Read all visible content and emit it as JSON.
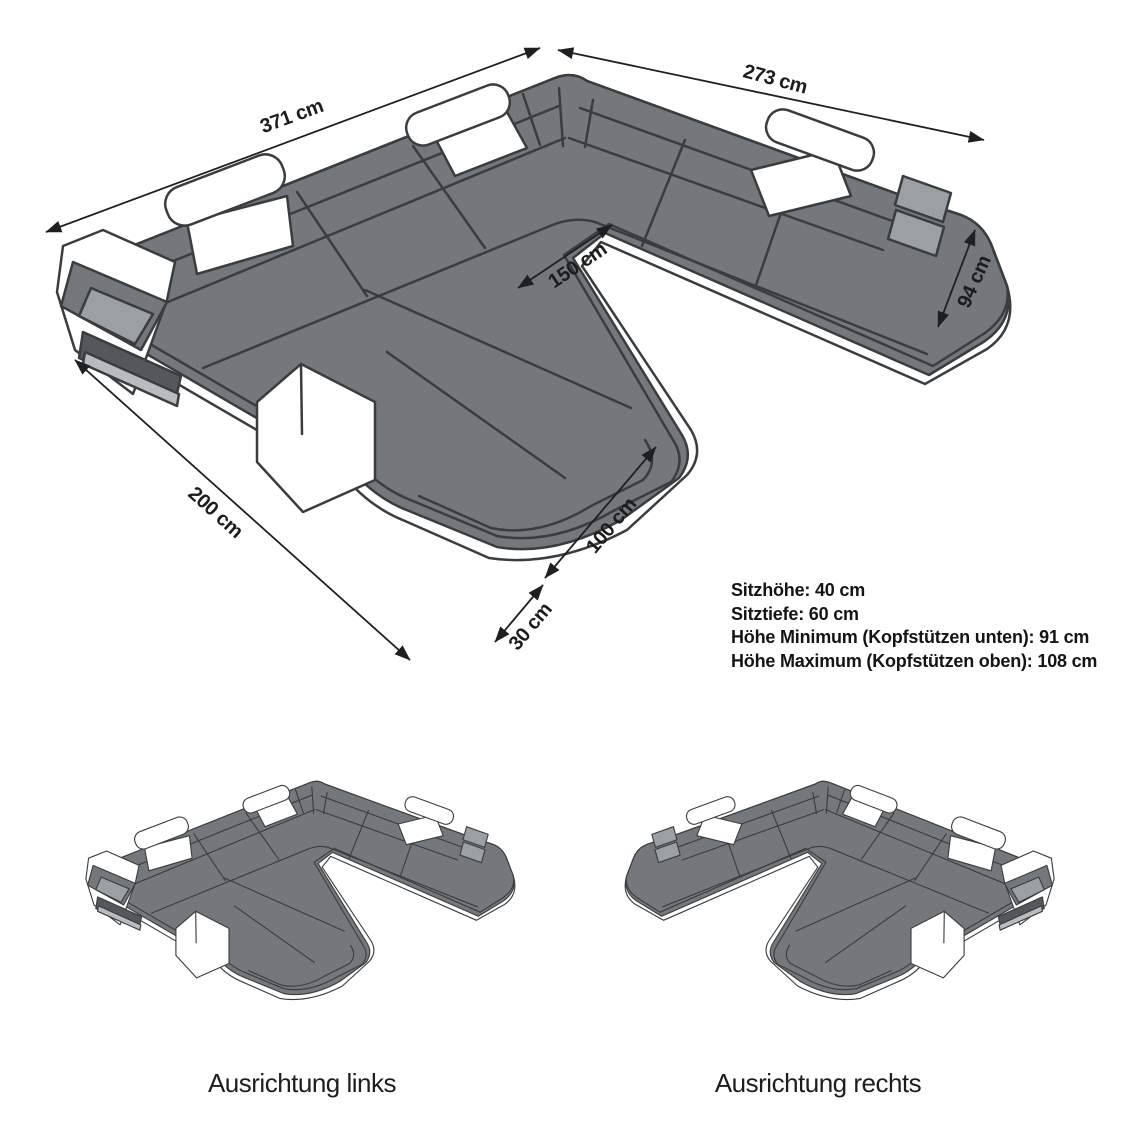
{
  "diagram": {
    "dimensions": [
      {
        "id": "371",
        "label": "371 cm"
      },
      {
        "id": "273",
        "label": "273 cm"
      },
      {
        "id": "150",
        "label": "150 cm"
      },
      {
        "id": "94",
        "label": "94 cm"
      },
      {
        "id": "200",
        "label": "200 cm"
      },
      {
        "id": "100",
        "label": "100 cm"
      },
      {
        "id": "30",
        "label": "30 cm"
      }
    ],
    "specs": {
      "lines": [
        "Sitzhöhe: 40 cm",
        "Sitztiefe: 60 cm",
        "Höhe Minimum (Kopfstützen unten): 91 cm",
        "Höhe Maximum (Kopfstützen oben): 108 cm"
      ]
    },
    "variants": [
      {
        "caption": "Ausrichtung links"
      },
      {
        "caption": "Ausrichtung rechts"
      }
    ],
    "colors": {
      "sofa_body": "#75787b",
      "sofa_light_panel": "#9ba0a3",
      "sofa_inner_dark": "#55585a",
      "sofa_slat": "#b9bcbe",
      "outline": "#3a3d40",
      "arrow": "#1f1f1f",
      "accent_white": "#ffffff",
      "text": "#1a1a1a"
    }
  }
}
